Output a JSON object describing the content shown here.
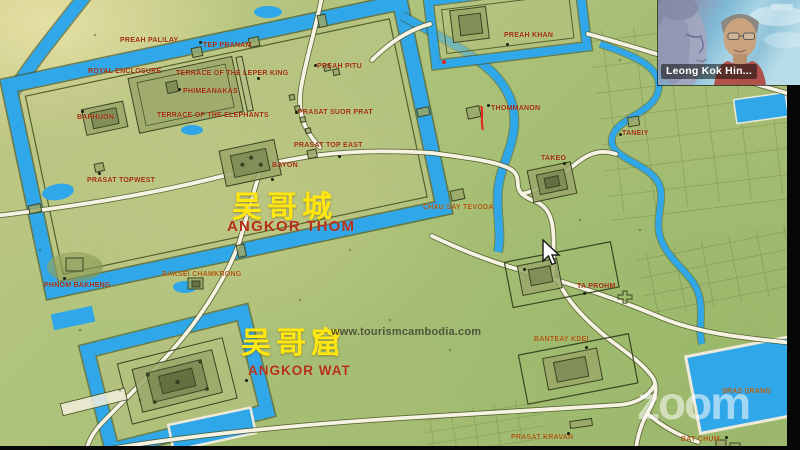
{
  "meeting": {
    "participant_name": "Leong Kok Hin...",
    "zoom_watermark": "zoom"
  },
  "map": {
    "watermark_site": "www.tourismcambodia.com",
    "regions": {
      "angkor_thom": {
        "zh": "吴哥城",
        "en": "ANGKOR THOM"
      },
      "angkor_wat": {
        "zh": "吴哥窟",
        "en": "ANGKOR WAT"
      }
    },
    "labels": [
      {
        "text": "PREAH PALILAY",
        "x": 120,
        "y": 37,
        "tone": "r"
      },
      {
        "text": "TEP PRANAM",
        "x": 203,
        "y": 42,
        "tone": "r"
      },
      {
        "text": "ROYAL ENCLOSURE",
        "x": 88,
        "y": 68,
        "tone": "r"
      },
      {
        "text": "TERRACE OF THE LEPER KING",
        "x": 176,
        "y": 70,
        "tone": "r"
      },
      {
        "text": "PHIMEANAKAS",
        "x": 183,
        "y": 88,
        "tone": "r"
      },
      {
        "text": "BAPHUON",
        "x": 77,
        "y": 114,
        "tone": "r"
      },
      {
        "text": "TERRACE OF THE ELEPHANTS",
        "x": 157,
        "y": 112,
        "tone": "r"
      },
      {
        "text": "PREAH PITU",
        "x": 317,
        "y": 63,
        "tone": "r"
      },
      {
        "text": "PRASAT SUOR PRAT",
        "x": 298,
        "y": 109,
        "tone": "r"
      },
      {
        "text": "PRASAT TOP EAST",
        "x": 294,
        "y": 142,
        "tone": "r"
      },
      {
        "text": "BAYON",
        "x": 272,
        "y": 162,
        "tone": "r"
      },
      {
        "text": "PRASAT TOPWEST",
        "x": 87,
        "y": 177,
        "tone": "r"
      },
      {
        "text": "PREAH KHAN",
        "x": 504,
        "y": 32,
        "tone": "r"
      },
      {
        "text": "THOMMANON",
        "x": 491,
        "y": 105,
        "tone": "r"
      },
      {
        "text": "TANEIY",
        "x": 622,
        "y": 130,
        "tone": "r"
      },
      {
        "text": "TAKEO",
        "x": 541,
        "y": 155,
        "tone": "r"
      },
      {
        "text": "CHAU SAY TEVODA",
        "x": 423,
        "y": 204,
        "tone": "o"
      },
      {
        "text": "PHNOM BAKHENG",
        "x": 44,
        "y": 282,
        "tone": "r"
      },
      {
        "text": "BAKSEI CHAMKRONG",
        "x": 162,
        "y": 271,
        "tone": "o"
      },
      {
        "text": "TA PROHM",
        "x": 577,
        "y": 283,
        "tone": "r"
      },
      {
        "text": "BANTEAY KDEI",
        "x": 534,
        "y": 336,
        "tone": "o"
      },
      {
        "text": "SRAS SRANG",
        "x": 722,
        "y": 388,
        "tone": "o"
      },
      {
        "text": "PRASAT KRAVAN",
        "x": 511,
        "y": 434,
        "tone": "o"
      },
      {
        "text": "BAT CHUM",
        "x": 681,
        "y": 436,
        "tone": "o"
      }
    ],
    "dots": [
      {
        "x": 199,
        "y": 41
      },
      {
        "x": 257,
        "y": 77
      },
      {
        "x": 178,
        "y": 88
      },
      {
        "x": 81,
        "y": 110
      },
      {
        "x": 314,
        "y": 64
      },
      {
        "x": 295,
        "y": 111
      },
      {
        "x": 338,
        "y": 155
      },
      {
        "x": 271,
        "y": 178
      },
      {
        "x": 98,
        "y": 172
      },
      {
        "x": 506,
        "y": 43
      },
      {
        "x": 487,
        "y": 104
      },
      {
        "x": 619,
        "y": 133
      },
      {
        "x": 563,
        "y": 162
      },
      {
        "x": 63,
        "y": 277
      },
      {
        "x": 583,
        "y": 292
      },
      {
        "x": 585,
        "y": 346
      },
      {
        "x": 567,
        "y": 432
      },
      {
        "x": 725,
        "y": 436
      },
      {
        "x": 245,
        "y": 379
      },
      {
        "x": 523,
        "y": 268
      }
    ],
    "colors": {
      "water": "#2fa7e8",
      "road": "#f6f3e4",
      "label_red": "#9d2c0d",
      "label_orange": "#a8570f",
      "title_red": "#b43019",
      "chinese_yellow": "#ffe70f",
      "terrain_green": "#a6be74"
    }
  }
}
